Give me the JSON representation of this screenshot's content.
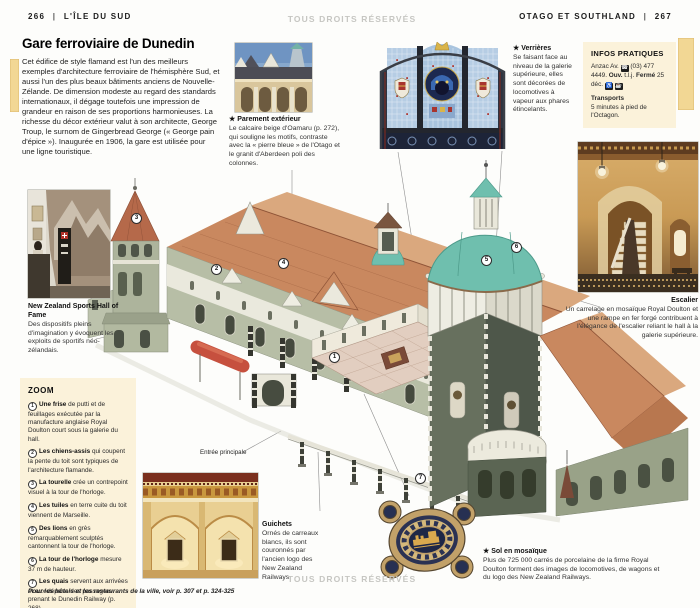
{
  "page": {
    "left_page_number": "266",
    "left_section": "L'ÎLE DU SUD",
    "right_section": "OTAGO ET SOUTHLAND",
    "right_page_number": "267",
    "divider": "|",
    "copyright_watermark": "TOUS DROITS RÉSERVÉS",
    "footer_note": "Pour les hôtels et les restaurants de la ville, voir p. 307 et p. 324-325"
  },
  "intro": {
    "title": "Gare ferroviaire de Dunedin",
    "body": "Cet édifice de style flamand est l'un des meilleurs exemples d'architecture ferroviaire de l'hémisphère Sud, et aussi l'un des plus beaux bâtiments anciens de Nouvelle-Zélande. De dimension modeste au regard des standards internationaux, il dégage toutefois une impression de grandeur en raison de ses proportions harmonieuses. La richesse du décor extérieur valut à son architecte, George Troup, le surnom de Gingerbread George (« George pain d'épice »). Inaugurée en 1906, la gare est utilisée pour une ligne touristique."
  },
  "captions": {
    "parement_title": "★ Parement extérieur",
    "parement_body": "Le calcaire beige d'Oamaru (p. 272), qui souligne les motifs, contraste avec la « pierre bleue » de l'Otago et le granit d'Aberdeen poli des colonnes.",
    "verrieres_title": "★ Verrières",
    "verrieres_body": "Se faisant face au niveau de la galerie supérieure, elles sont décorées de locomotives à vapeur aux phares étincelants.",
    "escalier_title": "Escalier",
    "escalier_body": "Un carrelage en mosaïque Royal Doulton et une rampe en fer forgé contribuent à l'élégance de l'escalier reliant le hall à la galerie supérieure.",
    "hof_title": "New Zealand Sports Hall of Fame",
    "hof_body": "Des dispositifs pleins d'imagination y évoquent les exploits de sportifs néo-zélandais.",
    "guichets_title": "Guichets",
    "guichets_body": "Ornés de carreaux blancs, ils sont couronnés par l'ancien logo des New Zealand Railways.",
    "sol_title": "★ Sol en mosaïque",
    "sol_body": "Plus de 725 000 carrés de porcelaine de la firme Royal Doulton forment des images de locomotives, de wagons et du logo des New Zealand Railways."
  },
  "infos": {
    "title": "INFOS PRATIQUES",
    "address": "Anzac Av.",
    "phone": "(03) 477 4449.",
    "open_label": "Ouv.",
    "open_value": "t.l.j.",
    "closed_label": "Fermé",
    "closed_value": "25 déc.",
    "transport_heading": "Transports",
    "transport_text": "5 minutes à pied de l'Octagon."
  },
  "icons": {
    "phone": "☎",
    "wheelchair": "♿",
    "cafe": "☕"
  },
  "zoom_box": {
    "title": "ZOOM",
    "items": [
      {
        "num": "1",
        "lead": "Une frise",
        "text": "de putti et de feuillages exécutée par la manufacture anglaise Royal Doulton court sous la galerie du hall."
      },
      {
        "num": "2",
        "lead": "Les chiens-assis",
        "text": "qui coupent la pente du toit sont typiques de l'architecture flamande."
      },
      {
        "num": "3",
        "lead": "La tourelle",
        "text": "crée un contrepoint visuel à la tour de l'horloge."
      },
      {
        "num": "4",
        "lead": "Les tuiles",
        "text": "en terre cuite du toit viennent de Marseille."
      },
      {
        "num": "5",
        "lead": "Des lions",
        "text": "en grès remarquablement sculptés cantonnent la tour de l'horloge."
      },
      {
        "num": "6",
        "lead": "La tour de l'horloge",
        "text": "mesure 37 m de hauteur."
      },
      {
        "num": "7",
        "lead": "Les quais",
        "text": "servent aux arrivées et aux départs des passagers prenant le Dunedin Railway (p. 268)."
      }
    ]
  },
  "illustration": {
    "entrance_label": "Entrée principale",
    "callouts": [
      "1",
      "2",
      "3",
      "4",
      "5",
      "6",
      "7"
    ]
  },
  "colors": {
    "thumb_tab": "#f2d794",
    "info_box_bg": "#fbf2da",
    "roof_terracotta": "#c9885f",
    "dome_teal": "#6fbfae",
    "stone_green": "#b7bea6",
    "watermark_gray": "#c6c6c2"
  }
}
